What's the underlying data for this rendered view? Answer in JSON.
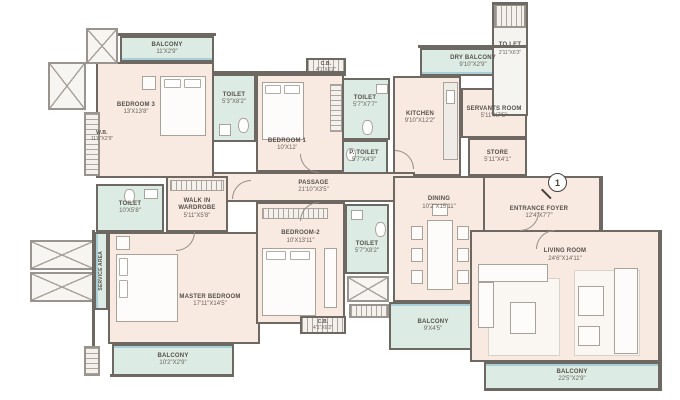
{
  "marker_label": "1",
  "colors": {
    "room_fill": "#f8e9e1",
    "wet_fill": "#dcebe3",
    "wall": "#6e6862",
    "wall_light": "#99948d",
    "accent_line": "#a9cfd8",
    "text": "#55504a"
  },
  "rooms": {
    "balcony_b3": {
      "name": "BALCONY",
      "dims": "11'X2'9\""
    },
    "bedroom3": {
      "name": "BEDROOM 3",
      "dims": "13'X13'8\""
    },
    "wb": {
      "name": "W.B.",
      "dims": "11'6\"X2'9\""
    },
    "toilet_b3": {
      "name": "TOILET",
      "dims": "5'3\"X8'2\""
    },
    "bedroom1": {
      "name": "BEDROOM 1",
      "dims": "10'X12'"
    },
    "cb_top": {
      "name": "C.B.",
      "dims": "4'1\"X6'2\""
    },
    "toilet_b1": {
      "name": "TOILET",
      "dims": "5'7\"X7'7\""
    },
    "p_toilet": {
      "name": "P. TOILET",
      "dims": "5'7\"X4'3\""
    },
    "dry_balcony": {
      "name": "DRY BALCONY",
      "dims": "9'10\"X2'9\""
    },
    "to_let": {
      "name": "TO LET",
      "dims": "2'11\"X6'3\""
    },
    "kitchen": {
      "name": "KITCHEN",
      "dims": "9'10\"X12'2\""
    },
    "servants_room": {
      "name": "SERVANTS ROOM",
      "dims": "5'11\"X7'5\""
    },
    "store": {
      "name": "STORE",
      "dims": "5'11\"X4'1\""
    },
    "passage": {
      "name": "PASSAGE",
      "dims": "21'10\"X3'5\""
    },
    "entrance_foyer": {
      "name": "ENTRANCE FOYER",
      "dims": "12'4\"X7'7\""
    },
    "dining": {
      "name": "DINING",
      "dims": "10'2\"X15'11\""
    },
    "toilet_master": {
      "name": "TOILET",
      "dims": "10'X5'8\""
    },
    "walk_in_wardrobe": {
      "name": "WALK IN WARDROBE",
      "dims": "5'11\"X5'8\""
    },
    "service_area": {
      "name": "SERVICE AREA",
      "dims": ""
    },
    "master_bedroom": {
      "name": "MASTER BEDROOM",
      "dims": "17'11\"X14'5\""
    },
    "bedroom2": {
      "name": "BEDROOM-2",
      "dims": "10'X13'11\""
    },
    "toilet_b2": {
      "name": "TOILET",
      "dims": "5'7\"X8'2\""
    },
    "cb_bottom": {
      "name": "C.B.",
      "dims": "4'1\"X6'2\""
    },
    "balcony_mid": {
      "name": "BALCONY",
      "dims": "9'X4'5\""
    },
    "living_room": {
      "name": "LIVING ROOM",
      "dims": "24'6\"X14'11\""
    },
    "balcony_living": {
      "name": "BALCONY",
      "dims": "22'5\"X2'9\""
    },
    "balcony_master": {
      "name": "BALCONY",
      "dims": "10'2\"X2'9\""
    }
  }
}
